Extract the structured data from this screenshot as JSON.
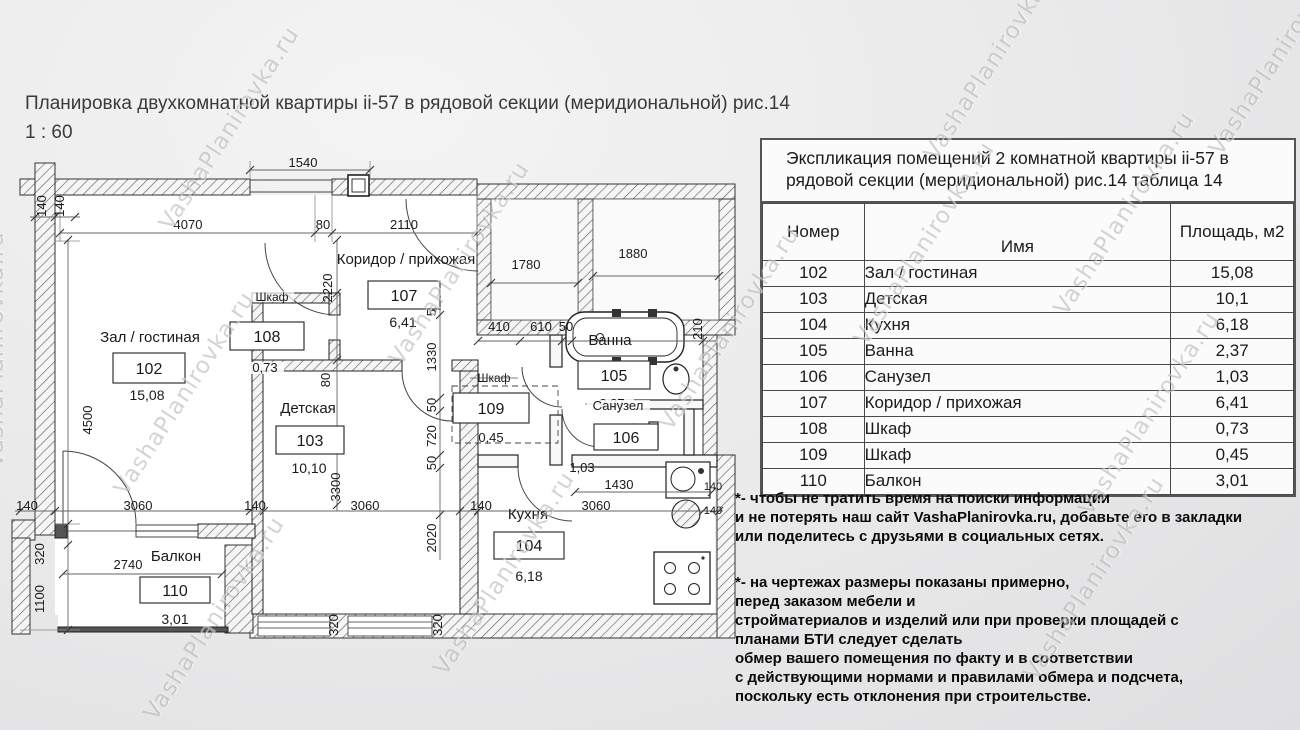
{
  "page": {
    "title": "Планировка двухкомнатной квартиры ii-57 в рядовой секции (меридиональной) рис.14",
    "scale": "1 : 60",
    "watermark": "VashaPlanirovka.ru"
  },
  "table": {
    "title": "Экспликация помещений 2 комнатной квартиры ii-57 в рядовой секции (меридиональной) рис.14 таблица 14",
    "columns": [
      "Номер",
      "Имя",
      "Площадь, м2"
    ],
    "rows": [
      {
        "num": "102",
        "name": "Зал / гостиная",
        "area": "15,08"
      },
      {
        "num": "103",
        "name": "Детская",
        "area": "10,1"
      },
      {
        "num": "104",
        "name": "Кухня",
        "area": "6,18"
      },
      {
        "num": "105",
        "name": "Ванна",
        "area": "2,37"
      },
      {
        "num": "106",
        "name": "Санузел",
        "area": "1,03"
      },
      {
        "num": "107",
        "name": "Коридор / прихожая",
        "area": "6,41"
      },
      {
        "num": "108",
        "name": "Шкаф",
        "area": "0,73"
      },
      {
        "num": "109",
        "name": "Шкаф",
        "area": "0,45"
      },
      {
        "num": "110",
        "name": "Балкон",
        "area": "3,01"
      }
    ]
  },
  "plan": {
    "rooms": {
      "living": {
        "name": "Зал / гостиная",
        "id": "102",
        "area": "15,08"
      },
      "kids": {
        "name": "Детская",
        "id": "103",
        "area": "10,10"
      },
      "kitchen": {
        "name": "Кухня",
        "id": "104",
        "area": "6,18"
      },
      "bath": {
        "name": "Ванна",
        "id": "105",
        "area": "2,37"
      },
      "wc": {
        "name": "Санузел",
        "id": "106",
        "area": "1,03"
      },
      "corridor": {
        "name": "Коридор / прихожая",
        "id": "107",
        "area": "6,41"
      },
      "closet1": {
        "name": "Шкаф",
        "id": "108",
        "area": "0,73"
      },
      "closet2": {
        "name": "Шкаф",
        "id": "109",
        "area": "0,45"
      },
      "balcony": {
        "name": "Балкон",
        "id": "110",
        "area": "3,01"
      }
    },
    "dims": {
      "d1540": "1540",
      "d4070": "4070",
      "d80": "80",
      "d2110": "2110",
      "d140": "140",
      "d4500": "4500",
      "d2220": "2220",
      "d1780": "1780",
      "d1880": "1880",
      "d410": "410",
      "d610": "610",
      "d50": "50",
      "d1330": "1330",
      "d720": "720",
      "d3300": "3300",
      "d3060": "3060",
      "d1430": "1430",
      "d2020": "2020",
      "d320": "320",
      "d2740": "2740",
      "d1100": "1100",
      "d210": "210"
    }
  },
  "notes": {
    "block1": [
      "*- чтобы не тратить время на поиски информации",
      " и не потерять наш сайт VashaPlanirovka.ru, добавьте его в закладки",
      "или поделитесь с друзьями в социальных сетях."
    ],
    "block2": [
      "*- на чертежах размеры показаны примерно,",
      "перед заказом мебели и",
      "стройматериалов и изделий или при проверки площадей с",
      "планами БТИ следует сделать",
      "обмер вашего помещения по факту и в соответствии",
      "с действующими нормами и правилами обмера и подсчета,",
      "поскольку есть отклонения при строительстве."
    ]
  }
}
